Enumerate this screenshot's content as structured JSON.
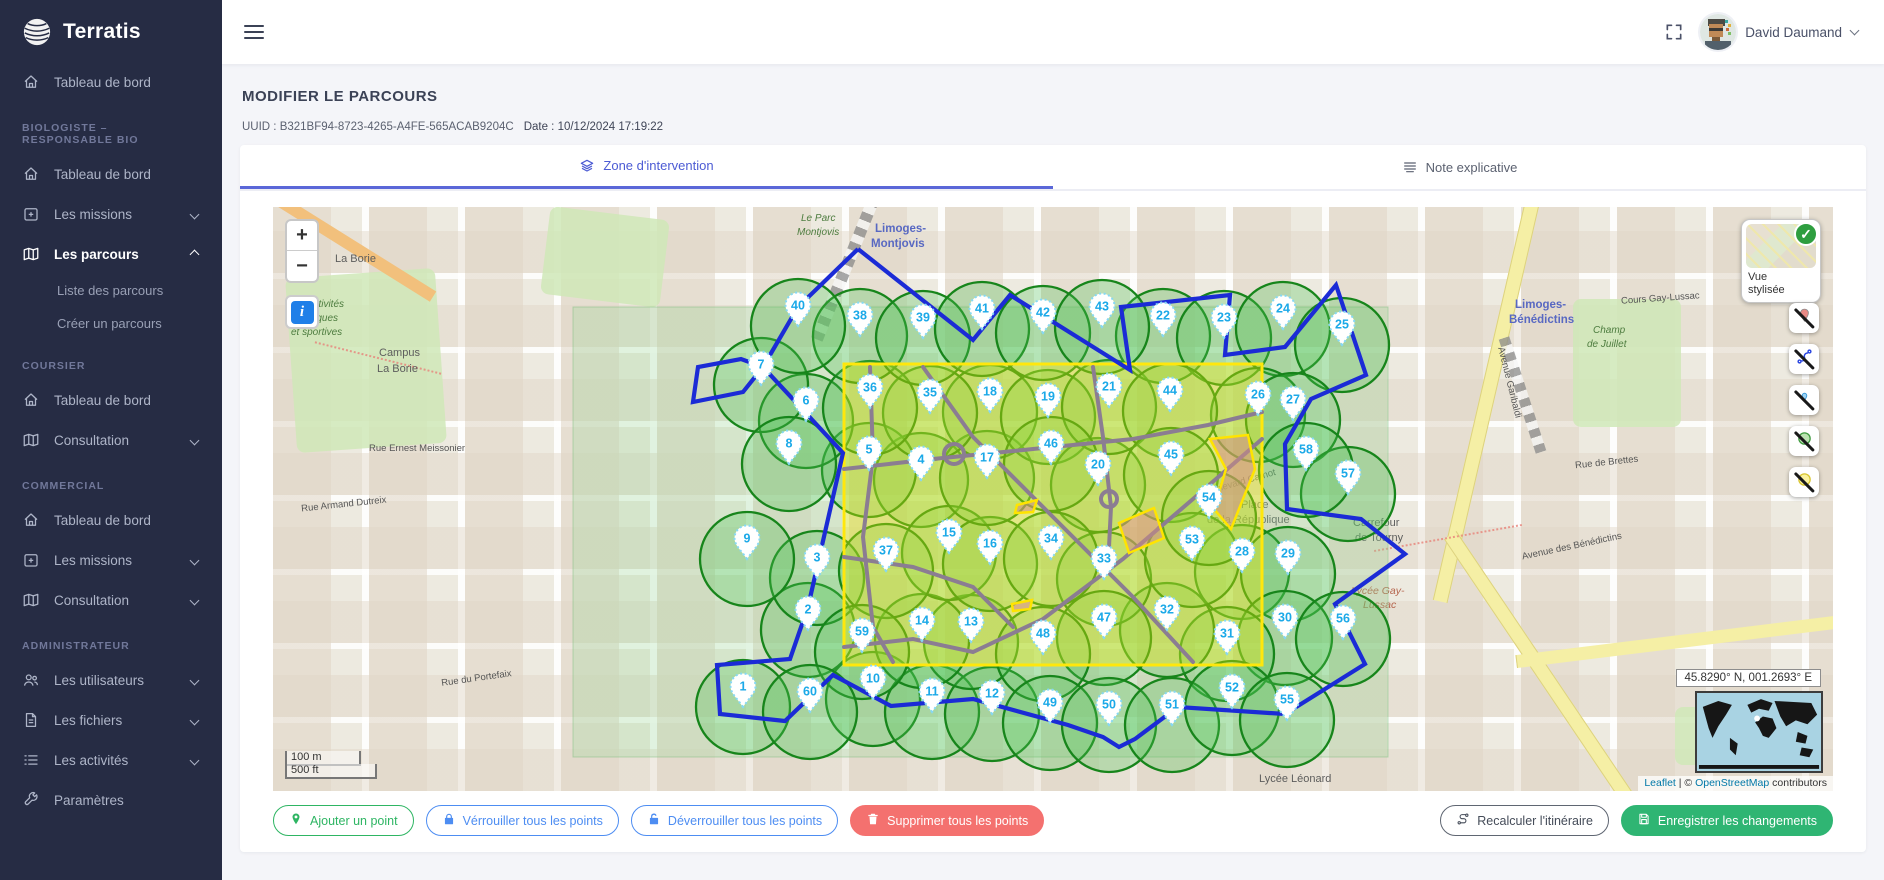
{
  "brand": {
    "name": "Terratis"
  },
  "topbar": {
    "user_name": "David Daumand"
  },
  "sidebar": {
    "sections": [
      {
        "header": "",
        "items": [
          {
            "label": "Tableau de bord",
            "icon": "home"
          }
        ]
      },
      {
        "header": "BIOLOGISTE – RESPONSABLE BIO",
        "items": [
          {
            "label": "Tableau de bord",
            "icon": "home"
          },
          {
            "label": "Les missions",
            "icon": "missions",
            "chevron": "down"
          },
          {
            "label": "Les parcours",
            "icon": "map",
            "chevron": "up",
            "active": true,
            "children": [
              {
                "label": "Liste des parcours"
              },
              {
                "label": "Créer un parcours"
              }
            ]
          }
        ]
      },
      {
        "header": "COURSIER",
        "items": [
          {
            "label": "Tableau de bord",
            "icon": "home"
          },
          {
            "label": "Consultation",
            "icon": "map",
            "chevron": "down"
          }
        ]
      },
      {
        "header": "COMMERCIAL",
        "items": [
          {
            "label": "Tableau de bord",
            "icon": "home"
          },
          {
            "label": "Les missions",
            "icon": "missions",
            "chevron": "down"
          },
          {
            "label": "Consultation",
            "icon": "map",
            "chevron": "down"
          }
        ]
      },
      {
        "header": "ADMINISTRATEUR",
        "items": [
          {
            "label": "Les utilisateurs",
            "icon": "users",
            "chevron": "down"
          },
          {
            "label": "Les fichiers",
            "icon": "file",
            "chevron": "down"
          },
          {
            "label": "Les activités",
            "icon": "list",
            "chevron": "down"
          },
          {
            "label": "Paramètres",
            "icon": "wrench"
          }
        ]
      }
    ]
  },
  "page": {
    "title": "MODIFIER LE PARCOURS",
    "uuid": "UUID : B321BF94-8723-4265-A4FE-565ACAB9204C",
    "date": "Date : 10/12/2024 17:19:22"
  },
  "tabs": [
    {
      "label": "Zone d'intervention",
      "icon": "layers",
      "active": true
    },
    {
      "label": "Note explicative",
      "icon": "note",
      "active": false
    }
  ],
  "map": {
    "controls": {
      "zoom_in": "+",
      "zoom_out": "−",
      "info": "i"
    },
    "style_card": {
      "label": "Vue stylisée",
      "check": "✓"
    },
    "scale": {
      "metric": "100 m",
      "imperial": "500 ft"
    },
    "coordinates": "45.8290° N, 001.2693° E",
    "attribution": {
      "leaflet": "Leaflet",
      "separator": " | © ",
      "osm_link": "OpenStreetMap",
      "suffix": " contributors"
    },
    "toggles": [
      {
        "name": "toggle-markers-visibility",
        "icon": "hide-marker"
      },
      {
        "name": "toggle-route-visibility",
        "icon": "hide-route"
      },
      {
        "name": "toggle-points-visibility",
        "icon": "hide-point"
      },
      {
        "name": "toggle-circles-visibility",
        "icon": "hide-circle"
      },
      {
        "name": "toggle-zone-visibility",
        "icon": "hide-zone"
      }
    ],
    "labels": [
      {
        "t": "La Borie",
        "x": 62,
        "y": 46,
        "c": "lbl-place"
      },
      {
        "t": "Campus",
        "x": 106,
        "y": 140,
        "c": "lbl-place"
      },
      {
        "t": "La Borie",
        "x": 104,
        "y": 156,
        "c": "lbl-place"
      },
      {
        "t": "des activités",
        "x": 16,
        "y": 92,
        "c": "lbl-green"
      },
      {
        "t": "physiques",
        "x": 20,
        "y": 106,
        "c": "lbl-green"
      },
      {
        "t": "et sportives",
        "x": 18,
        "y": 120,
        "c": "lbl-green"
      },
      {
        "t": "Le Parc",
        "x": 528,
        "y": 6,
        "c": "lbl-green"
      },
      {
        "t": "Montjovis",
        "x": 524,
        "y": 20,
        "c": "lbl-green"
      },
      {
        "t": "Limoges-",
        "x": 602,
        "y": 16,
        "c": "lbl-station"
      },
      {
        "t": "Montjovis",
        "x": 598,
        "y": 31,
        "c": "lbl-station"
      },
      {
        "t": "Limoges-",
        "x": 1242,
        "y": 92,
        "c": "lbl-station"
      },
      {
        "t": "Bénédictins",
        "x": 1236,
        "y": 107,
        "c": "lbl-station"
      },
      {
        "t": "Champ",
        "x": 1320,
        "y": 118,
        "c": "lbl-green"
      },
      {
        "t": "de Juillet",
        "x": 1314,
        "y": 132,
        "c": "lbl-green"
      },
      {
        "t": "Place",
        "x": 968,
        "y": 292,
        "c": "lbl-place"
      },
      {
        "t": "de la République",
        "x": 934,
        "y": 307,
        "c": "lbl-place"
      },
      {
        "t": "Carrefour",
        "x": 1080,
        "y": 310,
        "c": "lbl-place"
      },
      {
        "t": "de Tourny",
        "x": 1082,
        "y": 325,
        "c": "lbl-place"
      },
      {
        "t": "Lycée Gay-",
        "x": 1078,
        "y": 378,
        "c": "lbl-school"
      },
      {
        "t": "Lussac",
        "x": 1090,
        "y": 392,
        "c": "lbl-school"
      },
      {
        "t": "Lycée Léonard",
        "x": 986,
        "y": 566,
        "c": "lbl-place"
      },
      {
        "t": "Rue Armand Dutreix",
        "x": 28,
        "y": 292,
        "c": "lbl-street",
        "r": -6
      },
      {
        "t": "Rue du Portefaix",
        "x": 168,
        "y": 466,
        "c": "lbl-street",
        "r": -8
      },
      {
        "t": "Avenue Garibaldi",
        "x": 1200,
        "y": 170,
        "c": "lbl-street",
        "r": 76
      },
      {
        "t": "Boulevard Carnot",
        "x": 930,
        "y": 270,
        "c": "lbl-street",
        "r": -16
      },
      {
        "t": "Cours Gay-Lussac",
        "x": 1348,
        "y": 86,
        "c": "lbl-street",
        "r": -4
      },
      {
        "t": "Avenue des Bénédictins",
        "x": 1248,
        "y": 334,
        "c": "lbl-street",
        "r": -12
      },
      {
        "t": "Rue de Brettes",
        "x": 1302,
        "y": 250,
        "c": "lbl-street",
        "r": -6
      },
      {
        "t": "Rue Ernest Meissonier",
        "x": 96,
        "y": 236,
        "c": "lbl-street"
      }
    ],
    "geometry": {
      "pale_zone": {
        "x": 300,
        "y": 100,
        "w": 815,
        "h": 450
      },
      "zone_rect": {
        "x": 571,
        "y": 157,
        "w": 418,
        "h": 301
      },
      "circle_radius": 47,
      "route_path": "M585 42 L700 133 L737 88 L857 163 L848 100 L957 88 L952 148 L1012 140 L1063 78 L1093 168 L1038 192 L1012 237 L1014 302 L1088 312 L1132 347 L1062 397 L1092 457 L1012 507 L905 500 L862 532 L846 540 L830 530 L795 518 L700 492 L618 499 L560 468 L512 514 L447 507 L444 458 L517 452 L535 400 L570 246 L490 160 L470 185 L420 195 L425 160 L468 152 L490 160 L525 100 L585 42",
      "gray_paths": [
        "M597 160 L600 250 L590 330 L600 420 L620 455",
        "M571 262 L660 252 L760 242 L860 232 L935 218 L989 205",
        "M650 160 L700 230 L780 310 L860 390 L920 455",
        "M989 232 L920 292 L850 352 L770 412 L700 445 L640 432 L571 440",
        "M820 160 L830 230 L838 300 L835 360",
        "M571 350 L640 360 L700 380 L740 420"
      ],
      "yellow_polys": [
        "937,232 975,228 982,262 958,322 941,302 953,262",
        "846,316 881,301 891,331 856,346",
        "744,298 764,293 760,305 742,306",
        "739,397 759,393 757,402 740,404"
      ]
    },
    "markers": [
      {
        "n": 1,
        "x": 470,
        "y": 479
      },
      {
        "n": 2,
        "x": 535,
        "y": 402
      },
      {
        "n": 3,
        "x": 544,
        "y": 350
      },
      {
        "n": 4,
        "x": 648,
        "y": 252
      },
      {
        "n": 5,
        "x": 596,
        "y": 242
      },
      {
        "n": 6,
        "x": 533,
        "y": 193
      },
      {
        "n": 7,
        "x": 488,
        "y": 157
      },
      {
        "n": 8,
        "x": 516,
        "y": 236
      },
      {
        "n": 9,
        "x": 474,
        "y": 331
      },
      {
        "n": 10,
        "x": 600,
        "y": 471
      },
      {
        "n": 11,
        "x": 659,
        "y": 484
      },
      {
        "n": 12,
        "x": 719,
        "y": 486
      },
      {
        "n": 13,
        "x": 698,
        "y": 414
      },
      {
        "n": 14,
        "x": 649,
        "y": 413
      },
      {
        "n": 15,
        "x": 676,
        "y": 325
      },
      {
        "n": 16,
        "x": 717,
        "y": 336
      },
      {
        "n": 17,
        "x": 714,
        "y": 250
      },
      {
        "n": 18,
        "x": 717,
        "y": 184
      },
      {
        "n": 19,
        "x": 775,
        "y": 189
      },
      {
        "n": 20,
        "x": 825,
        "y": 257
      },
      {
        "n": 21,
        "x": 836,
        "y": 179
      },
      {
        "n": 22,
        "x": 890,
        "y": 108
      },
      {
        "n": 23,
        "x": 951,
        "y": 110
      },
      {
        "n": 24,
        "x": 1010,
        "y": 101
      },
      {
        "n": 25,
        "x": 1069,
        "y": 117
      },
      {
        "n": 26,
        "x": 985,
        "y": 187
      },
      {
        "n": 27,
        "x": 1020,
        "y": 192
      },
      {
        "n": 28,
        "x": 969,
        "y": 344
      },
      {
        "n": 29,
        "x": 1015,
        "y": 346
      },
      {
        "n": 30,
        "x": 1012,
        "y": 410
      },
      {
        "n": 31,
        "x": 954,
        "y": 426
      },
      {
        "n": 32,
        "x": 894,
        "y": 402
      },
      {
        "n": 33,
        "x": 831,
        "y": 351
      },
      {
        "n": 34,
        "x": 778,
        "y": 331
      },
      {
        "n": 35,
        "x": 657,
        "y": 185
      },
      {
        "n": 36,
        "x": 597,
        "y": 180
      },
      {
        "n": 37,
        "x": 613,
        "y": 343
      },
      {
        "n": 38,
        "x": 587,
        "y": 108
      },
      {
        "n": 39,
        "x": 650,
        "y": 110
      },
      {
        "n": 40,
        "x": 525,
        "y": 98
      },
      {
        "n": 41,
        "x": 709,
        "y": 101
      },
      {
        "n": 42,
        "x": 770,
        "y": 105
      },
      {
        "n": 43,
        "x": 829,
        "y": 99
      },
      {
        "n": 44,
        "x": 897,
        "y": 183
      },
      {
        "n": 45,
        "x": 898,
        "y": 247
      },
      {
        "n": 46,
        "x": 778,
        "y": 236
      },
      {
        "n": 47,
        "x": 831,
        "y": 410
      },
      {
        "n": 48,
        "x": 770,
        "y": 426
      },
      {
        "n": 49,
        "x": 777,
        "y": 495
      },
      {
        "n": 50,
        "x": 836,
        "y": 497
      },
      {
        "n": 51,
        "x": 899,
        "y": 497
      },
      {
        "n": 52,
        "x": 959,
        "y": 480
      },
      {
        "n": 53,
        "x": 919,
        "y": 332
      },
      {
        "n": 54,
        "x": 936,
        "y": 290
      },
      {
        "n": 55,
        "x": 1014,
        "y": 492
      },
      {
        "n": 56,
        "x": 1070,
        "y": 411
      },
      {
        "n": 57,
        "x": 1075,
        "y": 266
      },
      {
        "n": 58,
        "x": 1033,
        "y": 242
      },
      {
        "n": 59,
        "x": 589,
        "y": 424
      },
      {
        "n": 60,
        "x": 537,
        "y": 484
      }
    ],
    "colors": {
      "circle_fill": "rgba(80,195,85,0.30)",
      "circle_stroke": "#17851b",
      "zone_fill": "rgba(255,238,0,0.34)",
      "zone_stroke": "#ffe70c",
      "pale_fill": "rgba(150,214,150,0.28)",
      "pale_stroke": "rgba(130,190,130,0.5)",
      "route": "#1b2bd6",
      "gray_net": "#8b7d92",
      "poly_fill": "rgba(205,140,130,0.55)",
      "poly_stroke": "#ffe400",
      "marker_number": "#1ba9e8",
      "marker_border": "#86d8f4"
    }
  },
  "actions": {
    "left": [
      {
        "label": "Ajouter un point",
        "icon": "pin",
        "variant": "green-outline"
      },
      {
        "label": "Vérrouiller tous les points",
        "icon": "lock",
        "variant": "blue-outline"
      },
      {
        "label": "Déverrouiller tous les points",
        "icon": "unlock",
        "variant": "blue-outline"
      },
      {
        "label": "Supprimer tous les points",
        "icon": "trash",
        "variant": "red-solid"
      }
    ],
    "right": [
      {
        "label": "Recalculer l'itinéraire",
        "icon": "route",
        "variant": "gray-outline"
      },
      {
        "label": "Enregistrer les changements",
        "icon": "save",
        "variant": "green-solid"
      }
    ]
  }
}
